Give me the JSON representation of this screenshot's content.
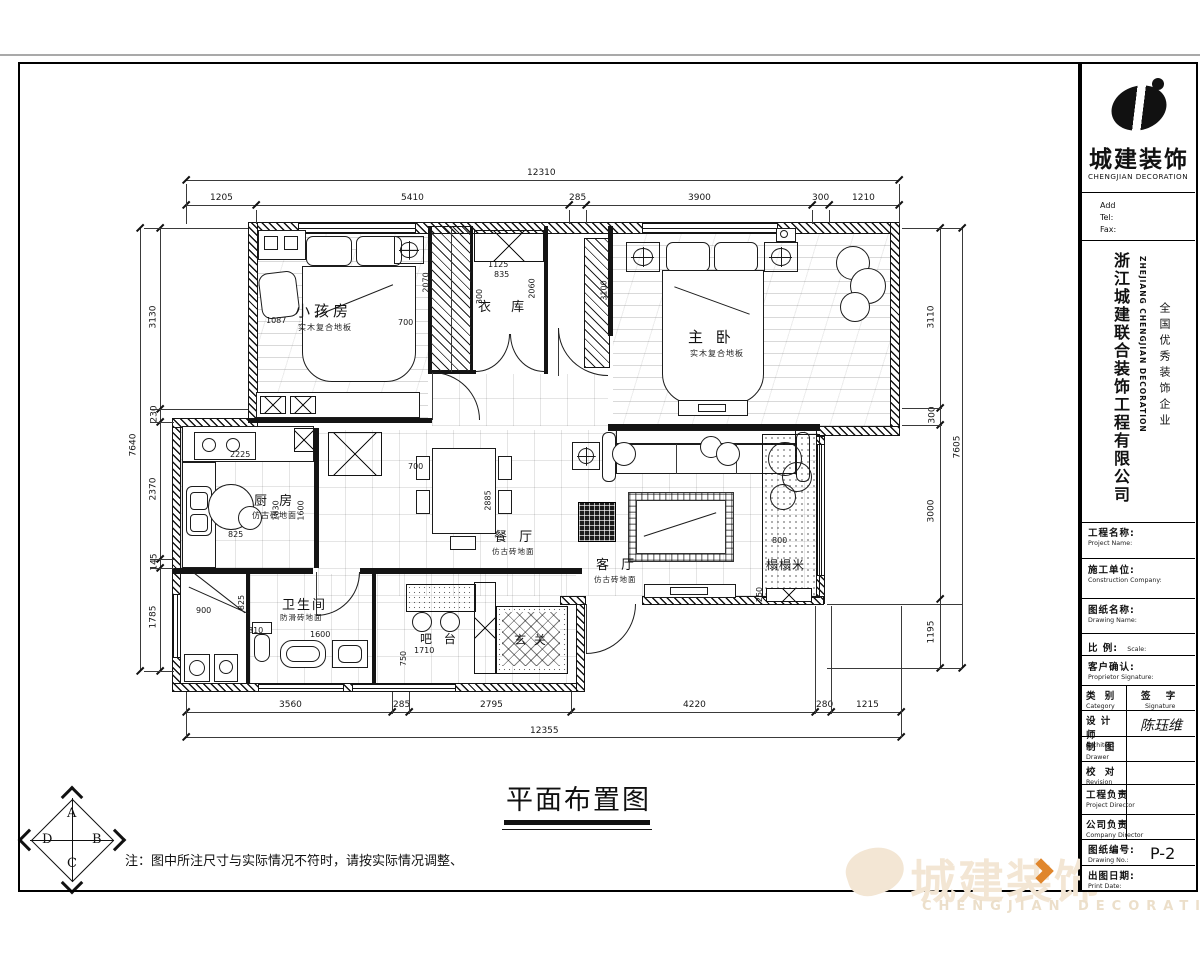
{
  "colors": {
    "accent_orange": "#e0862c",
    "watermark_beige": "#f3e6d4"
  },
  "header": {
    "logo_cn": "城建装饰",
    "logo_en": "CHENGJIAN  DECORATION",
    "add": "Add",
    "tel": "Tel:",
    "fax": "Fax:",
    "company_cn": "浙江城建联合装饰工程有限公司",
    "company_en": "ZHEJIANG CHENGJIAN DECORATION",
    "honor": "全国优秀装饰企业"
  },
  "fields": {
    "project": {
      "cn": "工程名称:",
      "en": "Project Name:"
    },
    "construction": {
      "cn": "施工单位:",
      "en": "Construction Company:"
    },
    "drawing": {
      "cn": "图纸名称:",
      "en": "Drawing Name:"
    },
    "scale": {
      "cn": "比 例:",
      "en": "Scale:"
    },
    "client": {
      "cn": "客户确认:",
      "en": "Proprietor Signature:"
    },
    "category": {
      "cn": "类 别",
      "en": "Category"
    },
    "signature": {
      "cn": "签 字",
      "en": "Signature"
    },
    "architect": {
      "cn": "设 计 师",
      "en": "Architect",
      "value": "陈珏维"
    },
    "drawer": {
      "cn": "制 图",
      "en": "Drawer",
      "value": ""
    },
    "revision": {
      "cn": "校 对",
      "en": "Revision",
      "value": ""
    },
    "proj_director": {
      "cn": "工程负责",
      "en": "Project Director",
      "value": ""
    },
    "comp_director": {
      "cn": "公司负责",
      "en": "Company Director",
      "value": ""
    },
    "drawing_no": {
      "cn": "图纸编号:",
      "en": "Drawing No.:",
      "value": "P-2"
    },
    "date": {
      "cn": "出图日期:",
      "en": "Print Date:",
      "value": ""
    }
  },
  "plan": {
    "title": "平面布置图",
    "note": "注：图中所注尺寸与实际情况不符时，请按实际情况调整、",
    "compass": {
      "a": "A",
      "b": "B",
      "c": "C",
      "d": "D"
    },
    "rooms": {
      "children": {
        "name": "小孩房",
        "floor": "实木复合地板"
      },
      "cloak": {
        "name": "衣 库"
      },
      "master": {
        "name": "主 卧",
        "floor": "实木复合地板"
      },
      "kitchen": {
        "name": "厨 房",
        "floor": "仿古砖地面"
      },
      "dining": {
        "name": "餐 厅",
        "floor": "仿古砖地面"
      },
      "living": {
        "name": "客 厅",
        "floor": "仿古砖地面"
      },
      "bath": {
        "name": "卫生间",
        "floor": "防滑砖地面"
      },
      "bar": {
        "name": "吧 台"
      },
      "entry": {
        "name": "玄 关"
      },
      "tatami": {
        "name": "榻榻米"
      }
    },
    "dims": {
      "top": {
        "total": "12310",
        "segments": [
          "1205",
          "5410",
          "285",
          "3900",
          "300",
          "1210"
        ]
      },
      "bottom": {
        "total": "12355",
        "segments": [
          "3560",
          "285",
          "2795",
          "4220",
          "280",
          "1215"
        ]
      },
      "left": {
        "total": "7640",
        "segments": [
          "3130",
          "230",
          "2370",
          "145",
          "1785"
        ]
      },
      "right": {
        "total": "7605",
        "segments": [
          "3110",
          "300",
          "3000",
          "1195"
        ]
      },
      "inner": [
        "1087",
        "700",
        "2070",
        "1125",
        "835",
        "2060",
        "300",
        "3100",
        "2225",
        "825",
        "1830",
        "1600",
        "700",
        "2885",
        "900",
        "825",
        "810",
        "1600",
        "1710",
        "750",
        "800",
        "250"
      ]
    }
  },
  "watermark": {
    "cn": "城建装饰",
    "en": "CHENGJIAN DECORATION"
  }
}
